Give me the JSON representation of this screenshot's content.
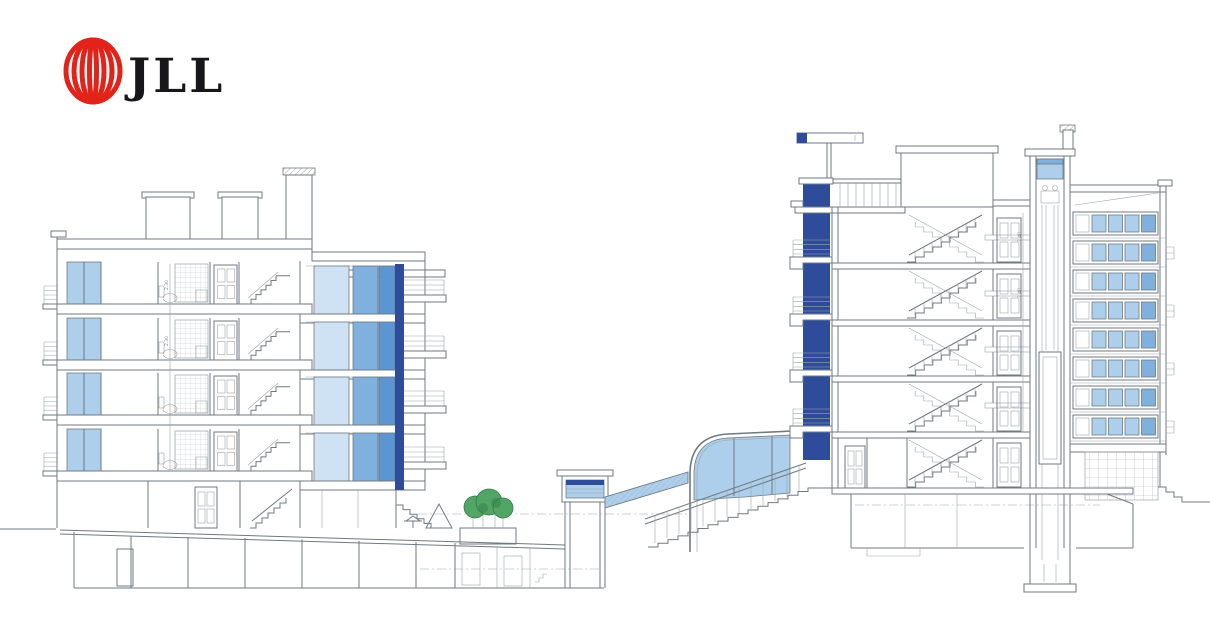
{
  "logo": {
    "brand": "JLL",
    "mark": "jll-rings-logo"
  },
  "dims": {
    "left_floor": "2.30",
    "right_floor": "2.40"
  },
  "colors": {
    "line": "#6f7a80",
    "line_light": "#9aa4a8",
    "ink": "#17171b",
    "logo_red": "#e2231a",
    "glass_lighter": "#cfe2f3",
    "glass_light": "#aecfeb",
    "glass_mid": "#7fb0de",
    "glass_deep": "#5b96d2",
    "navy": "#2e4c9a",
    "tree_green": "#53a566",
    "tree_dark": "#2f7d45",
    "paper": "#ffffff"
  },
  "drawing": {
    "type": "architectural-cross-section",
    "left_building": {
      "floors_above_ground": 5,
      "basement_levels": 1,
      "elements": [
        "balcony-railings",
        "bedroom-windows",
        "bathrooms",
        "panel-doors",
        "internal-stairs",
        "glazed-facade",
        "parking-garage"
      ]
    },
    "middle_area": {
      "elements": [
        "ground-dash-line",
        "parasol",
        "play-tent",
        "trees-on-planter",
        "garage-bays",
        "shaft-skylight",
        "sloped-skylight",
        "curved-glass-atrium",
        "outdoor-staircase"
      ]
    },
    "right_building": {
      "floors_above_ground": 6,
      "basement_levels": 1,
      "elements": [
        "roof-sign",
        "navy-curtain-wall",
        "balcony-railings",
        "stair-core",
        "landing-doors",
        "elevator-shaft",
        "elevator-pit",
        "ribbon-windows",
        "tiled-base-wall",
        "penthouse"
      ]
    }
  }
}
